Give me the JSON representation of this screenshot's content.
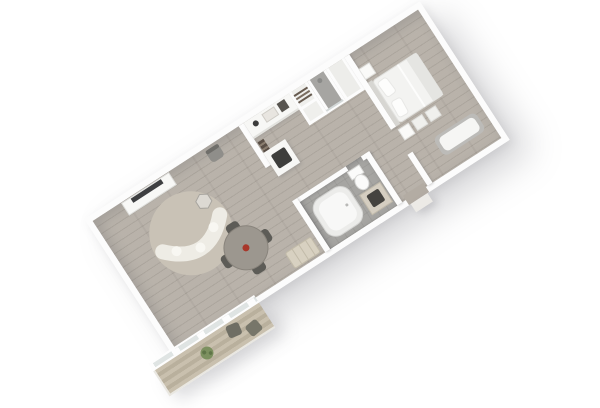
{
  "scene": {
    "type": "3d-floor-plan-render",
    "description": "Top-down 3D rendering of a one-bedroom suite floor plan rotated diagonally on a white background, with living-dining room, balcony deck, kitchenette, closets, shower, bathroom and bedroom",
    "rotation_deg": -33,
    "background": "#ffffff"
  },
  "palette": {
    "background": "#ffffff",
    "wall": "#fcfcfc",
    "wood": "#b3aca3",
    "tile": "#a6a5a2",
    "deck_a": "#c9c0ae",
    "deck_b": "#b9b09d",
    "rug": "#c9c2b6",
    "sofa": "#eeece5",
    "table": "#9c978f",
    "chair": "#5d5c57",
    "accent_red": "#a8372a",
    "linen": "#f3f3f1",
    "green": "#7c905f",
    "counter": "#f7f7f5",
    "dark": "#3e3e3c",
    "vanity": "#d5cec1",
    "glass": "#dfe4e3"
  },
  "rooms": [
    {
      "name": "living-dining-room",
      "floor": "wood"
    },
    {
      "name": "balcony-deck",
      "floor": "wood-deck"
    },
    {
      "name": "kitchenette",
      "floor": "wood"
    },
    {
      "name": "closet",
      "floor": "wood"
    },
    {
      "name": "shower-room",
      "floor": "gray-tile"
    },
    {
      "name": "bathroom",
      "floor": "gray-tile"
    },
    {
      "name": "hallway",
      "floor": "wood"
    },
    {
      "name": "bedroom",
      "floor": "wood"
    }
  ],
  "furniture": [
    {
      "name": "tv-console",
      "room": "living-dining-room"
    },
    {
      "name": "tv",
      "room": "living-dining-room"
    },
    {
      "name": "desk-chair",
      "room": "living-dining-room"
    },
    {
      "name": "round-rug",
      "room": "living-dining-room"
    },
    {
      "name": "curved-sofa",
      "room": "living-dining-room"
    },
    {
      "name": "hexagon-coffee-table",
      "room": "living-dining-room"
    },
    {
      "name": "round-dining-table-with-red-centerpiece",
      "room": "living-dining-room"
    },
    {
      "name": "dining-chairs-x4",
      "room": "living-dining-room"
    },
    {
      "name": "wood-sideboard",
      "room": "living-dining-room"
    },
    {
      "name": "potted-plant",
      "room": "balcony-deck"
    },
    {
      "name": "deck-chairs-x2",
      "room": "balcony-deck"
    },
    {
      "name": "kitchen-counter-appliances",
      "room": "kitchenette"
    },
    {
      "name": "wine-rack-shelf",
      "room": "kitchenette"
    },
    {
      "name": "cooktop-peninsula",
      "room": "kitchenette"
    },
    {
      "name": "luggage-rack-shelves",
      "room": "closet"
    },
    {
      "name": "bathtub",
      "room": "bathroom"
    },
    {
      "name": "toilet",
      "room": "bathroom"
    },
    {
      "name": "vanity-with-dark-sink",
      "room": "bathroom"
    },
    {
      "name": "double-bed-with-pillows",
      "room": "bedroom"
    },
    {
      "name": "nightstands-x2",
      "room": "bedroom"
    },
    {
      "name": "foot-ottomans-x2",
      "room": "bedroom"
    },
    {
      "name": "chaise-lounge",
      "room": "bedroom"
    }
  ]
}
